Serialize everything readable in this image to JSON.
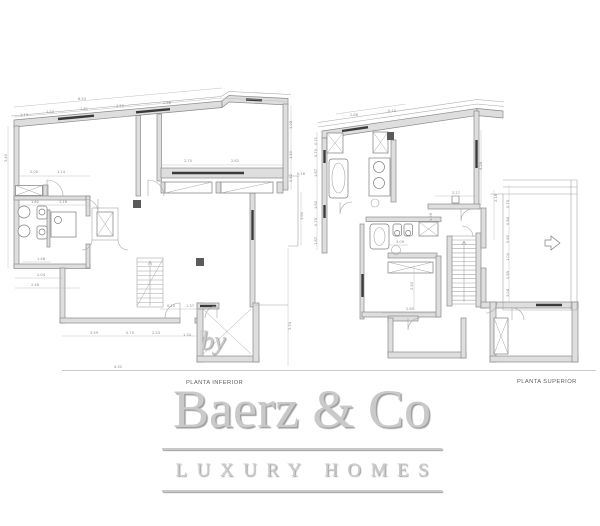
{
  "watermark": {
    "by": "by",
    "brand": "Baerz & Co",
    "tagline": "LUXURY HOMES"
  },
  "colors": {
    "background": "#ffffff",
    "wall_fill": "#dedede",
    "wall_stroke": "#8a8a8a",
    "window": "#3a3a3a",
    "thin": "#a6a6a6",
    "fixture": "#7d7d7d",
    "dim": "#b9b9b9",
    "dim_text": "#8c8c8c",
    "label_text": "#5f5f5f",
    "logo": "#c9c9c9",
    "logo_shadow": "#9e9e9e"
  },
  "plans": [
    {
      "id": "planta-inferior",
      "label": "PLANTA INFERIOR",
      "dimensions": [
        {
          "t": "8.53",
          "x": 78,
          "y": 100
        },
        {
          "t": "1.13",
          "x": 20,
          "y": 116
        },
        {
          "t": "1.50",
          "x": 46,
          "y": 113
        },
        {
          "t": "1.81",
          "x": 80,
          "y": 110
        },
        {
          "t": "1.50",
          "x": 116,
          "y": 107
        },
        {
          "t": "2.86",
          "x": 163,
          "y": 104
        },
        {
          "t": "3.40",
          "x": 7,
          "y": 162,
          "r": -90
        },
        {
          "t": "2.00",
          "x": 30,
          "y": 173
        },
        {
          "t": "1.14",
          "x": 57,
          "y": 173
        },
        {
          "t": "1.82",
          "x": 31,
          "y": 203
        },
        {
          "t": "1.18",
          "x": 59,
          "y": 203
        },
        {
          "t": "2.70",
          "x": 184,
          "y": 162
        },
        {
          "t": "2.82",
          "x": 231,
          "y": 162
        },
        {
          "t": "1.08",
          "x": 292,
          "y": 129,
          "r": -90
        },
        {
          "t": "1.50",
          "x": 292,
          "y": 159,
          "r": -90
        },
        {
          "t": "0.52",
          "x": 292,
          "y": 182,
          "r": -90
        },
        {
          "t": "0.16",
          "x": 297,
          "y": 175
        },
        {
          "t": "3.60",
          "x": 303,
          "y": 220,
          "r": -90
        },
        {
          "t": "3.74",
          "x": 291,
          "y": 330,
          "r": -90
        },
        {
          "t": "1.48",
          "x": 37,
          "y": 260
        },
        {
          "t": "2.04",
          "x": 37,
          "y": 276
        },
        {
          "t": "2.48",
          "x": 31,
          "y": 286
        },
        {
          "t": "0.20",
          "x": 167,
          "y": 307
        },
        {
          "t": "1.37",
          "x": 186,
          "y": 307
        },
        {
          "t": "3.59",
          "x": 90,
          "y": 334
        },
        {
          "t": "0.70",
          "x": 126,
          "y": 334
        },
        {
          "t": "2.23",
          "x": 152,
          "y": 334
        },
        {
          "t": "1.34",
          "x": 183,
          "y": 336
        },
        {
          "t": "0.88",
          "x": 205,
          "y": 345,
          "r": -90
        },
        {
          "t": "4.32",
          "x": 114,
          "y": 368
        }
      ]
    },
    {
      "id": "planta-superior",
      "label": "PLANTA SUPERIOR",
      "dimensions": [
        {
          "t": "2.86",
          "x": 350,
          "y": 116
        },
        {
          "t": "0.10",
          "x": 388,
          "y": 112
        },
        {
          "t": "0.71",
          "x": 317,
          "y": 145,
          "r": -90
        },
        {
          "t": "0.70",
          "x": 317,
          "y": 157,
          "r": -90
        },
        {
          "t": "1.87",
          "x": 317,
          "y": 177,
          "r": -90
        },
        {
          "t": "1.60",
          "x": 317,
          "y": 209,
          "r": -90
        },
        {
          "t": "0.75",
          "x": 317,
          "y": 226,
          "r": -90
        },
        {
          "t": "1.87",
          "x": 317,
          "y": 245,
          "r": -90
        },
        {
          "t": "4.26",
          "x": 482,
          "y": 170,
          "r": -90
        },
        {
          "t": "2.27",
          "x": 452,
          "y": 194
        },
        {
          "t": "2.18",
          "x": 497,
          "y": 202,
          "r": -90
        },
        {
          "t": "3.09",
          "x": 396,
          "y": 243
        },
        {
          "t": "1.06",
          "x": 432,
          "y": 221,
          "r": -90
        },
        {
          "t": "2.50",
          "x": 413,
          "y": 290,
          "r": -90
        },
        {
          "t": "2.60",
          "x": 406,
          "y": 310
        },
        {
          "t": "0.75",
          "x": 509,
          "y": 208,
          "r": -90
        },
        {
          "t": "0.84",
          "x": 509,
          "y": 225,
          "r": -90
        },
        {
          "t": "0.80",
          "x": 509,
          "y": 243,
          "r": -90
        },
        {
          "t": "1.00",
          "x": 509,
          "y": 261,
          "r": -90
        },
        {
          "t": "0.85",
          "x": 509,
          "y": 279,
          "r": -90
        },
        {
          "t": "3.04",
          "x": 509,
          "y": 297,
          "r": -90
        }
      ]
    }
  ]
}
